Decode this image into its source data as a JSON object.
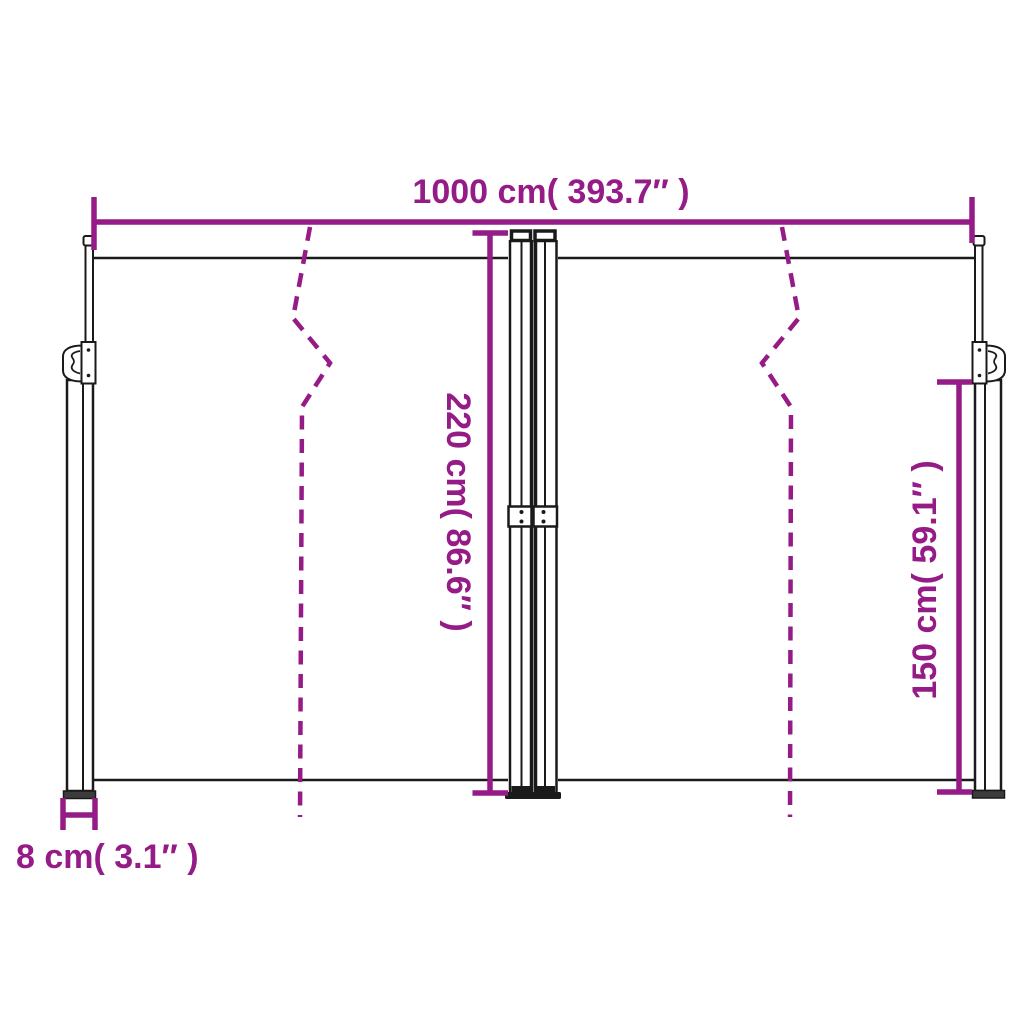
{
  "diagram": {
    "dimensions": {
      "width": "1000 cm( 393.7″ )",
      "height": "220 cm( 86.6″ )",
      "side_height": "150 cm( 59.1″ )",
      "pole_width": "8 cm( 3.1″ )"
    },
    "colors": {
      "accent": "#951B87",
      "ink": "#1A1A1A",
      "background": "#FFFFFF"
    }
  }
}
